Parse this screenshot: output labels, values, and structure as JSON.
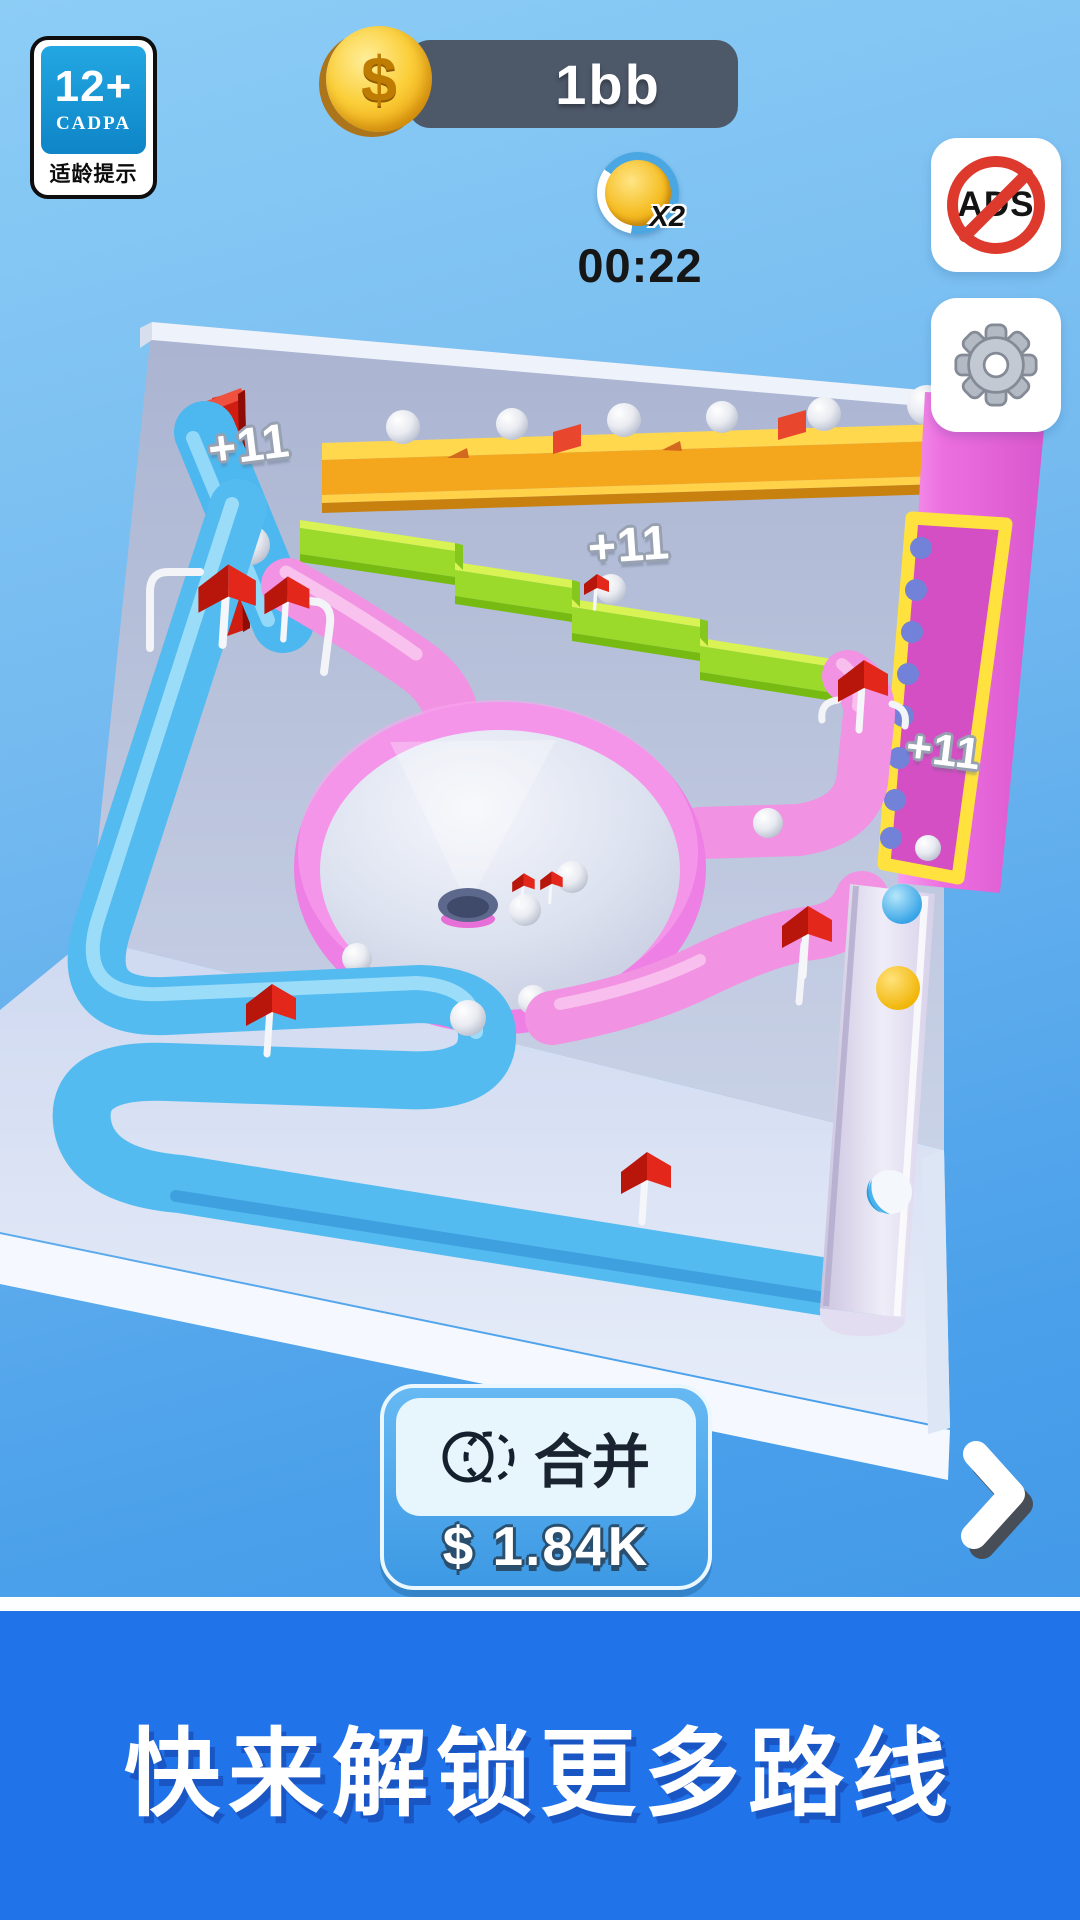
{
  "colors": {
    "sky_top": "#8ccdf6",
    "sky_bottom": "#3b92e6",
    "banner_blue": "#2173ea",
    "banner_shadow": "#1a55c4",
    "hud_pill": "#4d5869",
    "coin_gold": "#f5bd23",
    "accent_red": "#dd3a2d",
    "merge_button_blue": "#45a1e8",
    "track_pink": "#f292e2",
    "track_blue": "#54bbf0",
    "track_green": "#9bda2b",
    "track_yellow": "#f4a71d"
  },
  "hud": {
    "age_badge": {
      "rating": "12+",
      "organization": "CADPA",
      "caption": "适龄提示"
    },
    "coin_counter": {
      "currency_symbol": "$",
      "amount": "1bb"
    },
    "double_coins": {
      "multiplier_label": "X2",
      "countdown": "00:22"
    },
    "no_ads_button": {
      "label": "ADS",
      "icon": "no-ads"
    },
    "settings_button": {
      "icon": "gear"
    }
  },
  "scene": {
    "bonus_labels": [
      {
        "text": "+11"
      },
      {
        "text": "+11"
      },
      {
        "text": "+11"
      }
    ]
  },
  "footer": {
    "merge_button": {
      "label": "合并",
      "price": "$ 1.84K",
      "icon": "merge-circles"
    },
    "next_arrow": {
      "icon": "chevron-right"
    }
  },
  "banner": {
    "text": "快来解锁更多路线"
  }
}
